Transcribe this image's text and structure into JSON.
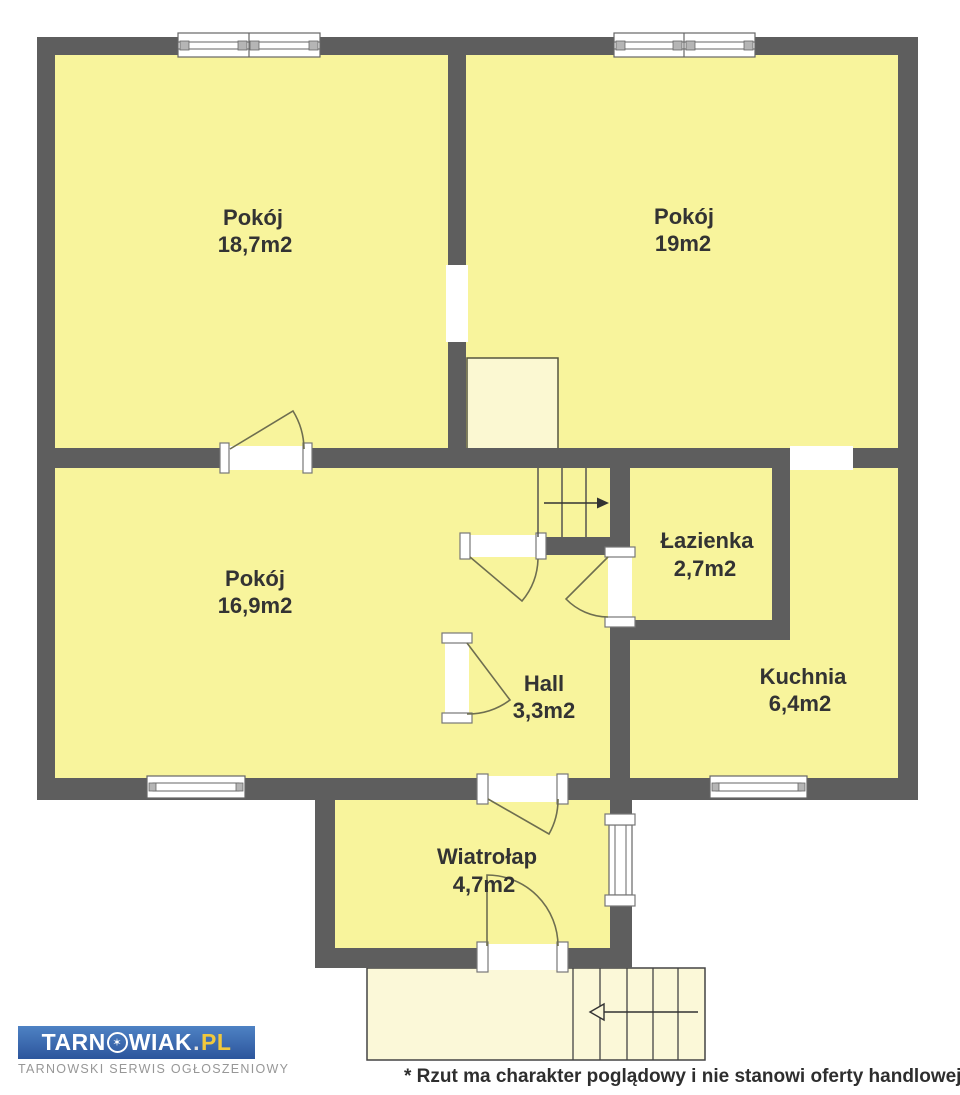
{
  "plan": {
    "rooms": [
      {
        "name": "Pokój",
        "area": "18,7m2"
      },
      {
        "name": "Pokój",
        "area": "19m2"
      },
      {
        "name": "Pokój",
        "area": "16,9m2"
      },
      {
        "name": "Łazienka",
        "area": "2,7m2"
      },
      {
        "name": "Kuchnia",
        "area": "6,4m2"
      },
      {
        "name": "Hall",
        "area": "3,3m2"
      },
      {
        "name": "Wiatrołap",
        "area": "4,7m2"
      }
    ],
    "colors": {
      "wall": "#5e5e5e",
      "floor": "#f8f49c",
      "light_area": "#fbf8d2",
      "opening": "#ffffff",
      "door_line": "#6e6e50",
      "label_text": "#333333"
    }
  },
  "footer": {
    "logo": {
      "brand_prefix": "TARN",
      "star_symbol": "✶",
      "brand_suffix": "WIAK",
      "dot": ".",
      "tld": "PL",
      "tagline": "TARNOWSKI SERWIS OGŁOSZENIOWY"
    },
    "disclaimer": "* Rzut ma charakter poglądowy i nie stanowi oferty handlowej"
  }
}
